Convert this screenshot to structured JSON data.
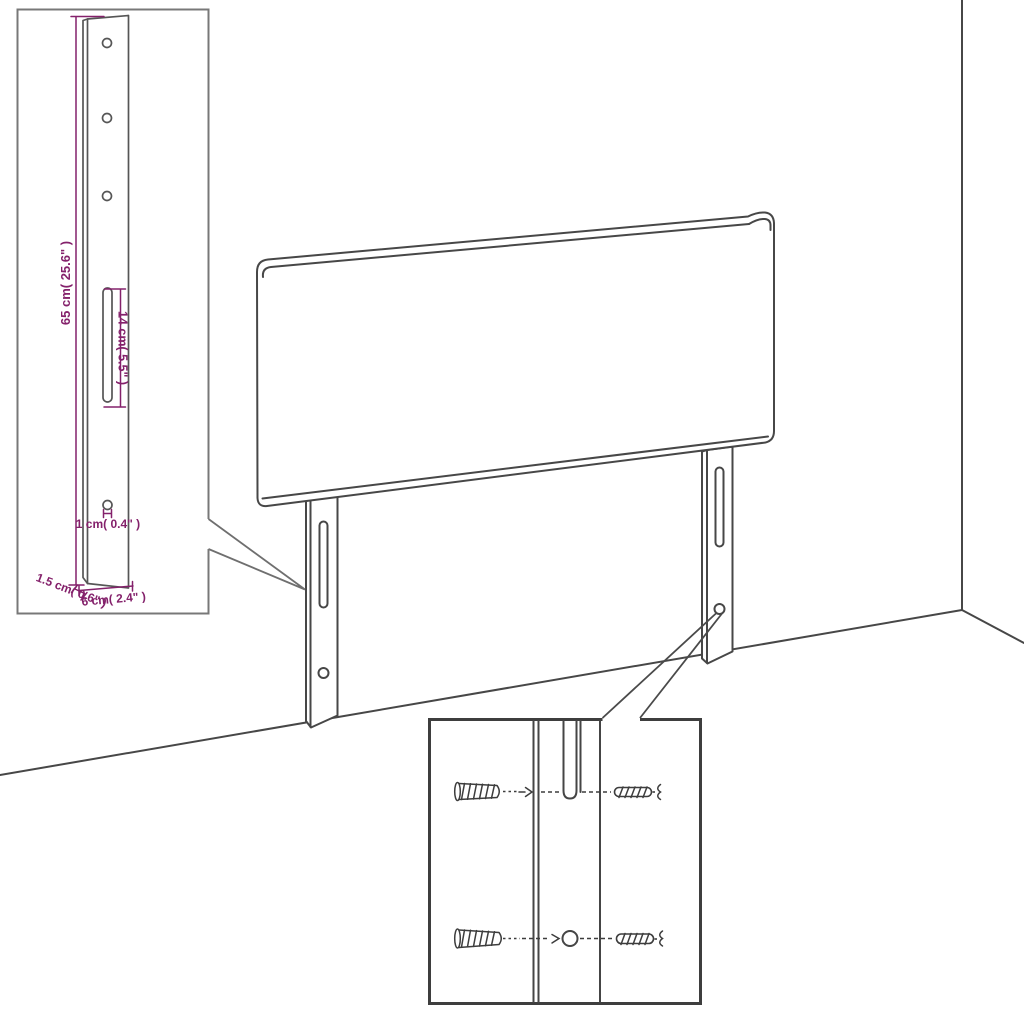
{
  "diagram_type": "headboard-assembly-product-diagram",
  "colors": {
    "annotation": "#84216B",
    "drawing_line": "#474747",
    "inset_box_border": "#787878",
    "detail_box_border": "#3e3e3e",
    "background": "#ffffff"
  },
  "leg_detail_inset": {
    "length_label": "65 cm( 25.6\" )",
    "slot_label": "14 cm( 5.5\" )",
    "hole_label": "1 cm( 0.4\" )",
    "edge_label": "1.5 cm( 0.6\" )",
    "width_label": "6 cm( 2.4\" )"
  }
}
